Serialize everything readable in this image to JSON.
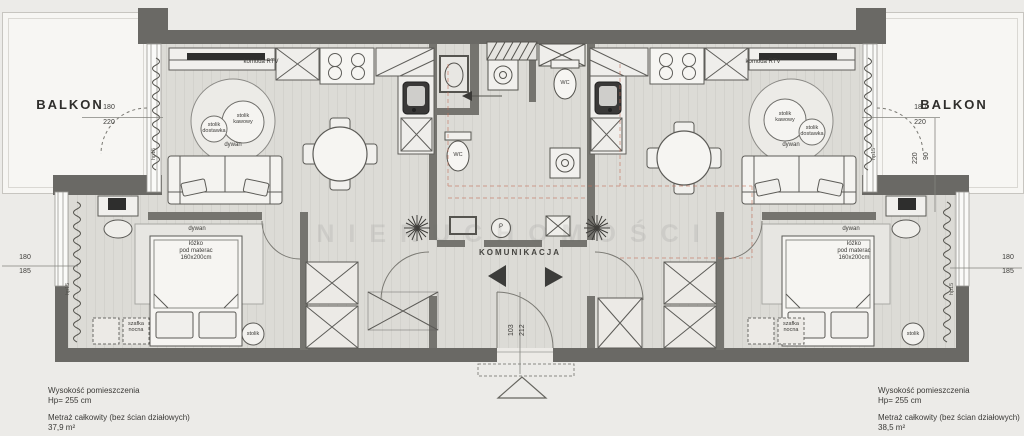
{
  "labels": {
    "balcony": "BALKON",
    "corridor": "KOMUNIKACJA"
  },
  "watermark": "NIERUCHOMOŚCI",
  "furniture": {
    "tv_unit": "komoda RTV",
    "rug": "dywan",
    "coffee_table": "stolik\nkawowy",
    "side_table": "stolik\ndostawka",
    "bed": "łóżko\npod materac\n160x200cm",
    "nightstand": "szafka\nnocna",
    "small_table": "stolik",
    "toilet": "WC",
    "washer": "P"
  },
  "dims": {
    "left_top": {
      "a": "180",
      "b": "220"
    },
    "left_bottom": {
      "a": "180",
      "b": "185"
    },
    "right_top": {
      "a": "180",
      "b": "220"
    },
    "right_side": {
      "a": "220",
      "b": "90"
    },
    "right_bottom": {
      "a": "180",
      "b": "185"
    },
    "entry": {
      "a": "103",
      "b": "212"
    },
    "sill": "hp15"
  },
  "notes": {
    "left": {
      "height": "Wysokość pomieszczenia\nHp= 255 cm",
      "area": "Metraż całkowity (bez ścian działowych)\n37,9 m²"
    },
    "right": {
      "height": "Wysokość pomieszczenia\nHp= 255 cm",
      "area": "Metraż całkowity (bez ścian działowych)\n38,5 m²"
    }
  },
  "colors": {
    "wall": "#6a6965",
    "partition": "#75746f",
    "floor": "#dcdbd6",
    "balcony": "#f7f6f3",
    "accent_red": "#c4705a"
  }
}
